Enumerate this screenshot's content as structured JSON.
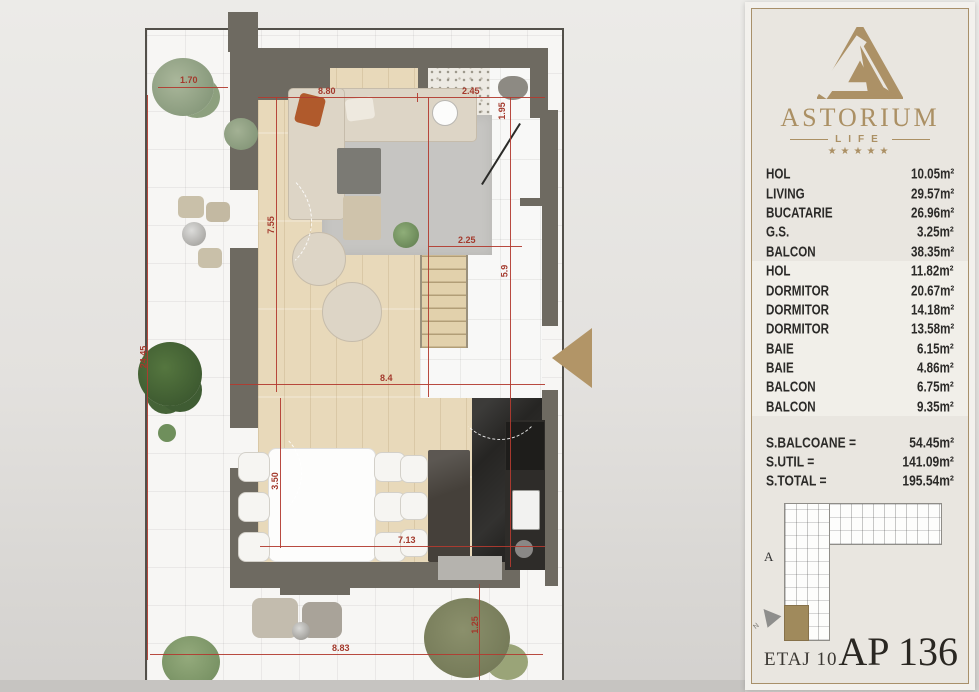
{
  "colors": {
    "accent_gold": "#b29567",
    "dimension_red": "#b23b30",
    "wall_gray": "#6e6a61",
    "panel_bg": "#e9e6e0"
  },
  "sidebar": {
    "brand": {
      "name": "ASTORIUM",
      "sub": "LIFE",
      "stars": "★★★★★"
    },
    "rooms": [
      {
        "label": "HOL",
        "area": "10.05m²"
      },
      {
        "label": "LIVING",
        "area": "29.57m²"
      },
      {
        "label": "BUCATARIE",
        "area": "26.96m²"
      },
      {
        "label": "G.S.",
        "area": "3.25m²"
      },
      {
        "label": "BALCON",
        "area": "38.35m²"
      },
      {
        "label": "HOL",
        "area": "11.82m²"
      },
      {
        "label": "DORMITOR",
        "area": "20.67m²"
      },
      {
        "label": "DORMITOR",
        "area": "14.18m²"
      },
      {
        "label": "DORMITOR",
        "area": "13.58m²"
      },
      {
        "label": "BAIE",
        "area": "6.15m²"
      },
      {
        "label": "BAIE",
        "area": "4.86m²"
      },
      {
        "label": "BALCON",
        "area": "6.75m²"
      },
      {
        "label": "BALCON",
        "area": "9.35m²"
      }
    ],
    "totals": [
      {
        "label": "S.BALCOANE =",
        "value": "54.45m²"
      },
      {
        "label": "S.UTIL =",
        "value": "141.09m²"
      },
      {
        "label": "S.TOTAL =",
        "value": "195.54m²"
      }
    ],
    "minimap": {
      "section_label": "A",
      "north_label": "N"
    },
    "footer": {
      "floor": "ETAJ 10",
      "apartment": "AP 136"
    }
  },
  "plan": {
    "dims": {
      "balcony_top": "1.70",
      "terrace_height": "24.45",
      "living_width": "8.80",
      "bath_width": "2.45",
      "bath_depth": "1.95",
      "living_height": "7.55",
      "stairs_width": "2.25",
      "hall_height": "5.9",
      "mid_width": "8.4",
      "dining_height": "3.50",
      "dining_width": "7.13",
      "bottom_width": "8.83",
      "bottom_right": "1.25"
    }
  }
}
